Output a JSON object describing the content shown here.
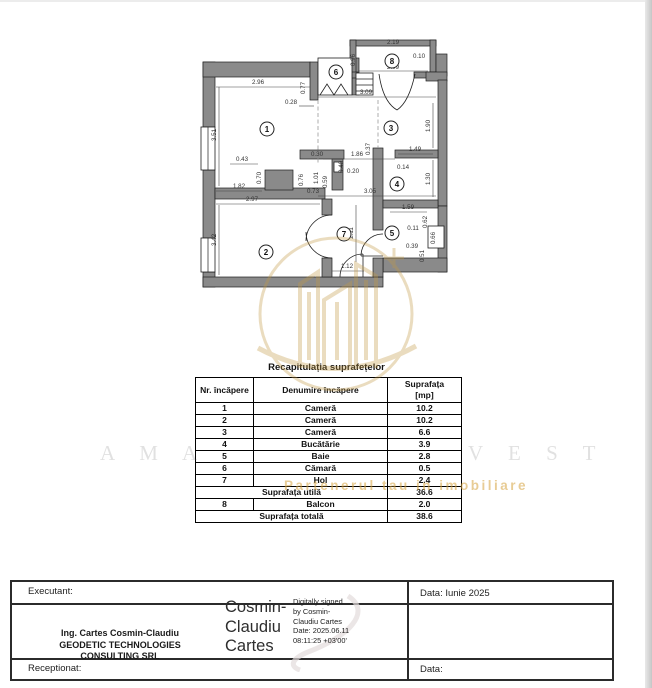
{
  "plan": {
    "rooms": [
      "1",
      "2",
      "3",
      "4",
      "5",
      "6",
      "7",
      "8"
    ],
    "dims": [
      "2.96",
      "3.51",
      "0.77",
      "0.28",
      "3.09",
      "1.90",
      "2.19",
      "0.96",
      "2.09",
      "0.10",
      "0.37",
      "1.49",
      "0.14",
      "1.30",
      "3.05",
      "0.30",
      "1.86",
      "0.40",
      "0.20",
      "0.59",
      "0.76",
      "0.73",
      "1.01",
      "0.43",
      "0.70",
      "1.82",
      "2.97",
      "3.42",
      "2.11",
      "1.12",
      "1.59",
      "0.62",
      "0.11",
      "0.66",
      "0.39",
      "0.51"
    ]
  },
  "table": {
    "title": "Recapitulația suprafețelor",
    "headers": {
      "nr": "Nr. încăpere",
      "name": "Denumire încăpere",
      "area1": "Suprafața",
      "area2": "[mp]"
    },
    "rows": [
      {
        "nr": "1",
        "name": "Cameră",
        "area": "10.2"
      },
      {
        "nr": "2",
        "name": "Cameră",
        "area": "10.2"
      },
      {
        "nr": "3",
        "name": "Cameră",
        "area": "6.6"
      },
      {
        "nr": "4",
        "name": "Bucătărie",
        "area": "3.9"
      },
      {
        "nr": "5",
        "name": "Baie",
        "area": "2.8"
      },
      {
        "nr": "6",
        "name": "Cămară",
        "area": "0.5"
      },
      {
        "nr": "7",
        "name": "Hol",
        "area": "2.4"
      }
    ],
    "util": {
      "label": "Suprafața utilă",
      "value": "36.6"
    },
    "balcon": {
      "nr": "8",
      "name": "Balcon",
      "value": "2.0"
    },
    "total": {
      "label": "Suprafața totală",
      "value": "38.6"
    }
  },
  "watermark": {
    "big_left": "A M A",
    "big_right": "V E S T",
    "slogan": "Partenerul tau in imobiliare"
  },
  "footer": {
    "executant_label": "Executant:",
    "date1": "Data: Iunie 2025",
    "engineer_line1": "Ing. Cartes Cosmin-Claudiu",
    "engineer_line2": "GEODETIC TECHNOLOGIES CONSULTING SRL",
    "signature": {
      "line1": "Cosmin-",
      "line2": "Claudiu",
      "line3": "Cartes"
    },
    "digital": {
      "l1": "Digitally signed",
      "l2": "by Cosmin-",
      "l3": "Claudiu Cartes",
      "l4": "Date: 2025.06.11",
      "l5": "08:11:25 +03'00'"
    },
    "receptionat_label": "Receptionat:",
    "date2": "Data:"
  }
}
